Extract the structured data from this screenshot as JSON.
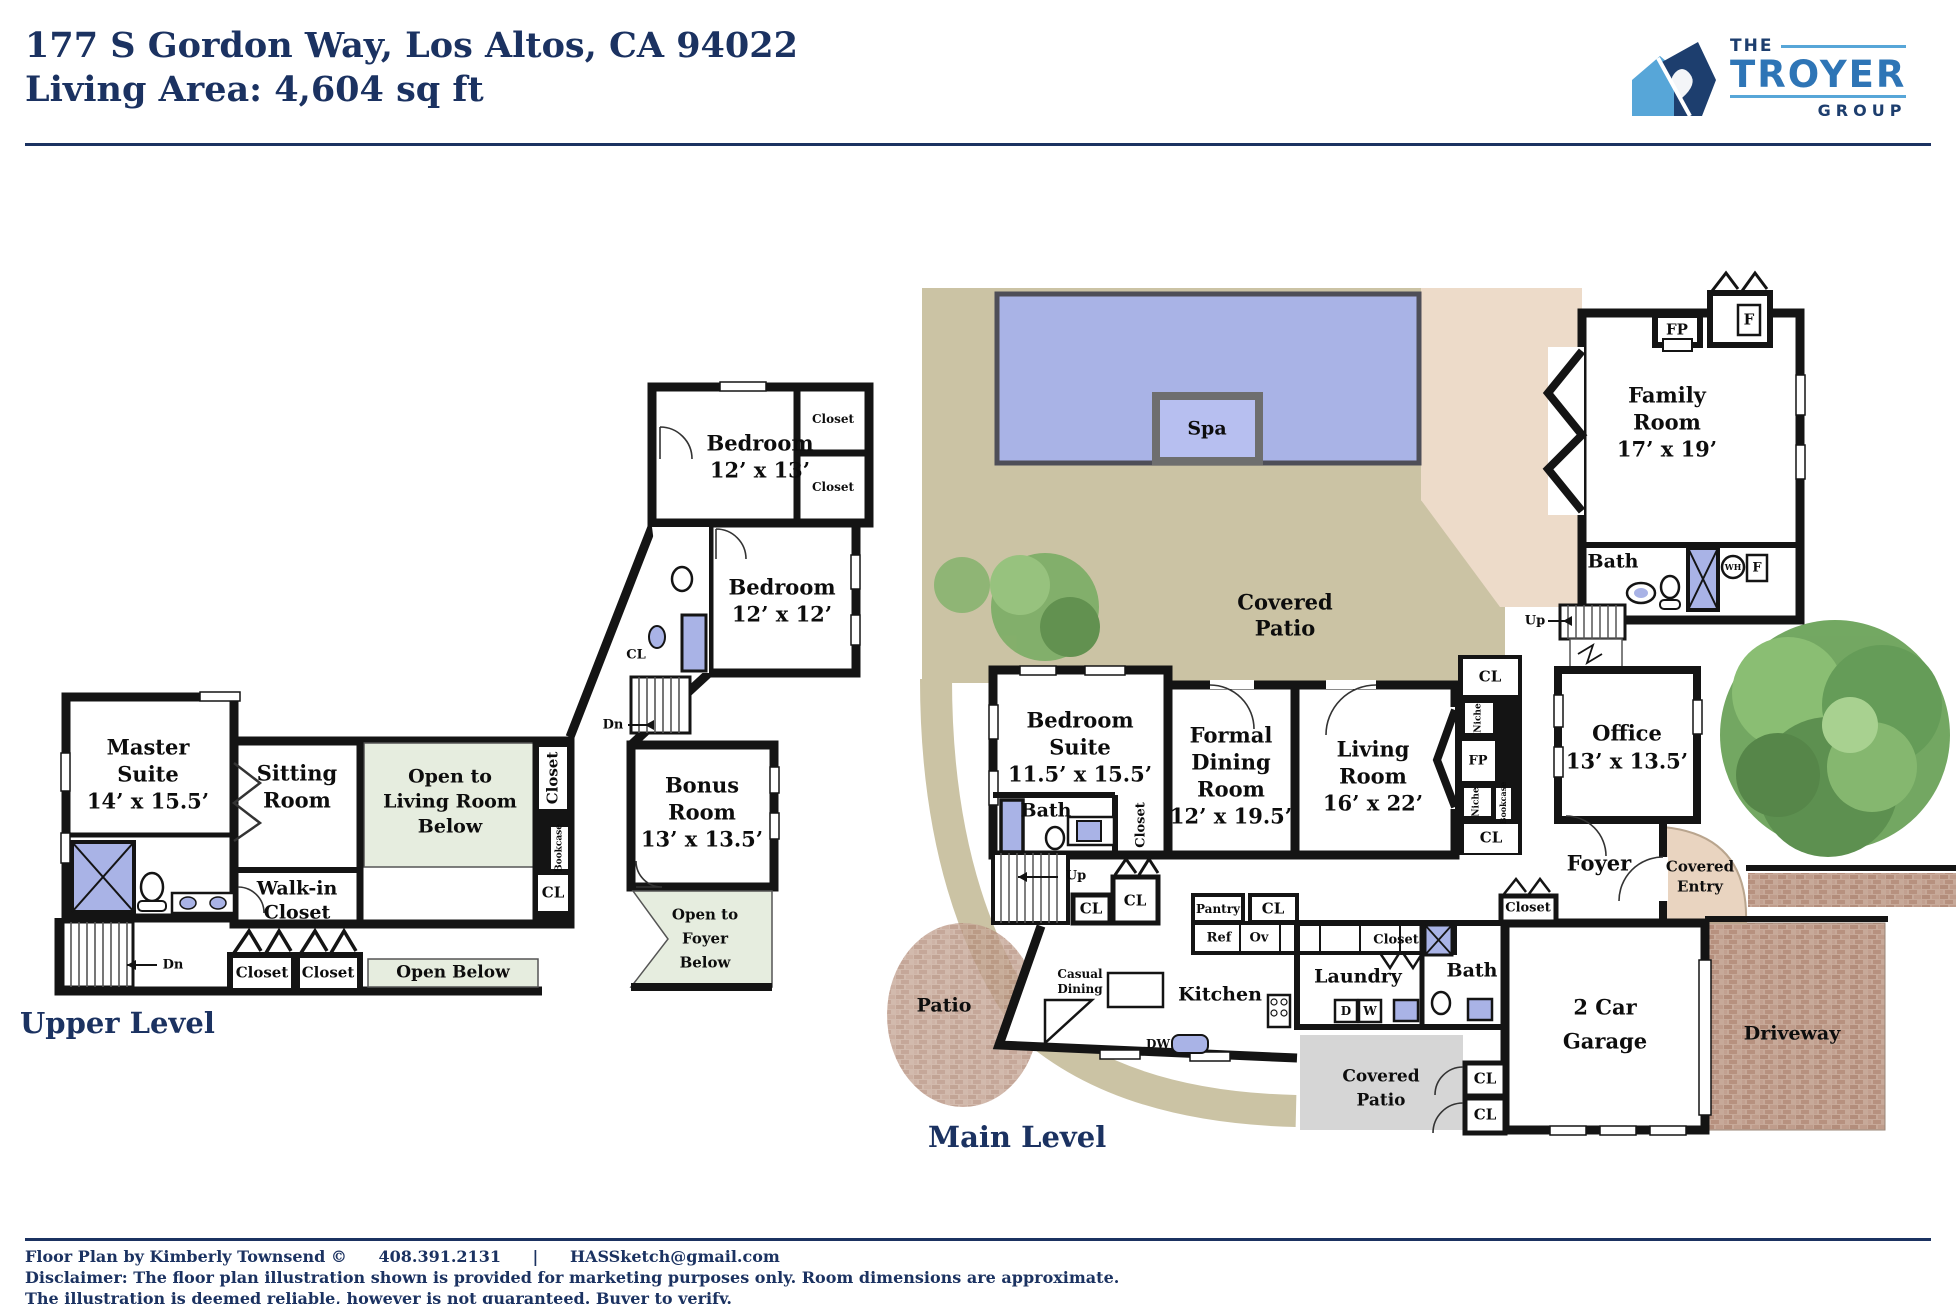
{
  "header": {
    "address": "177 S Gordon Way, Los Altos, CA 94022",
    "living_area": "Living Area: 4,604 sq ft",
    "logo": {
      "the": "THE",
      "name": "TROYER",
      "group": "GROUP"
    }
  },
  "upper": {
    "label": "Upper Level",
    "master1": "Master",
    "master2": "Suite",
    "master3": "14’ x 15.5’",
    "sitting1": "Sitting",
    "sitting2": "Room",
    "walkin1": "Walk-in",
    "walkin2": "Closet",
    "openliving1": "Open to",
    "openliving2": "Living Room",
    "openliving3": "Below",
    "closet_v": "Closet",
    "bookcase_v": "Bookcase",
    "cl1": "CL",
    "closeta": "Closet",
    "closetb": "Closet",
    "openbelow": "Open Below",
    "openfoyer1": "Open to",
    "openfoyer2": "Foyer",
    "openfoyer3": "Below",
    "bonus1": "Bonus",
    "bonus2": "Room",
    "bonus3": "13’ x 13.5’",
    "bed1a": "Bedroom",
    "bed1b": "12’ x 13’",
    "bed2a": "Bedroom",
    "bed2b": "12’ x 12’",
    "closetc": "Closet",
    "closetd": "Closet",
    "cl2": "CL",
    "dn1": "Dn",
    "dn2": "Dn"
  },
  "main": {
    "label": "Main Level",
    "spa": "Spa",
    "covpatio1": "Covered",
    "covpatio2": "Patio",
    "family1": "Family",
    "family2": "Room",
    "family3": "17’ x 19’",
    "fp_family": "FP",
    "f_top": "F",
    "bath_family": "Bath",
    "wh": "WH",
    "f_bath": "F",
    "up_right": "Up",
    "up_left": "Up",
    "cl_strip_top": "CL",
    "niche1": "Niche",
    "fp_strip": "FP",
    "niche2": "Niche",
    "bookcase_v": "Bookcase",
    "cl_strip_bot": "CL",
    "office1": "Office",
    "office2": "13’ x 13.5’",
    "foyer": "Foyer",
    "covent1": "Covered",
    "covent2": "Entry",
    "closet_foyer": "Closet",
    "garage1": "2 Car",
    "garage2": "Garage",
    "driveway": "Driveway",
    "clg1": "CL",
    "clg2": "CL",
    "bath_garage": "Bath",
    "laundry": "Laundry",
    "closet_laundry": "Closet",
    "d": "D",
    "w": "W",
    "covpatio_b1": "Covered",
    "covpatio_b2": "Patio",
    "kitchen": "Kitchen",
    "casual1": "Casual",
    "casual2": "Dining",
    "dw": "DW",
    "pantry": "Pantry",
    "cl_pantry": "CL",
    "ref": "Ref",
    "ov": "Ov",
    "suite1": "Bedroom",
    "suite2": "Suite",
    "suite3": "11.5’ x 15.5’",
    "bath_suite": "Bath",
    "closet_suite": "Closet",
    "formal1": "Formal",
    "formal2": "Dining",
    "formal3": "Room",
    "formal4": "12’ x 19.5’",
    "living1": "Living",
    "living2": "Room",
    "living3": "16’ x 22’",
    "cla": "CL",
    "clb": "CL",
    "patio": "Patio"
  },
  "footer": {
    "credit": "Floor Plan by Kimberly Townsend ©",
    "phone": "408.391.2131",
    "sep": "|",
    "email": "HASSketch@gmail.com",
    "disclaimer1": "Disclaimer: The floor plan illustration shown is provided for marketing purposes only. Room dimensions are approximate.",
    "disclaimer2": "The illustration is deemed reliable, however is not guaranteed. Buyer to verify."
  },
  "colors": {
    "navy": "#1b3261",
    "logo_light_blue": "#57a6d8",
    "logo_mid_blue": "#2e75b6",
    "wall": "#141414",
    "pool": "#a9b3e6",
    "tan_patio": "#cbc3a4",
    "pink_patio": "#eddbc9",
    "open_below_green": "#e6eddf",
    "covered_patio_gray": "#d6d6d6",
    "brick": "#c4a496",
    "fixture_blue": "#a9b3e6",
    "tree_green": "#5d9750"
  }
}
